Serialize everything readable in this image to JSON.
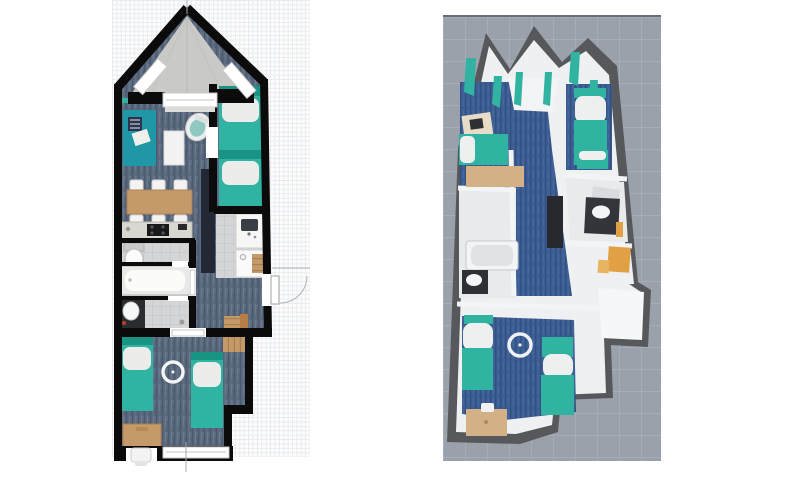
{
  "image": {
    "kind": "floor-plan comparison screenshot",
    "left_view": "2D top-down apartment floor plan on graph paper",
    "right_view": "3D aerial perspective render of the same apartment",
    "visible_text": ""
  },
  "colors": {
    "paper_bg": "#fdfdfe",
    "paper_line": "#e8ebed",
    "wall": "#0b0b0b",
    "carpet": "#5d6c81",
    "carpet_dark": "#4b5a6e",
    "carpet_light": "#6e7d91",
    "terrace": "#c9c9c5",
    "tile": "#d4d5d7",
    "tile_line": "#c0c2c4",
    "teal": "#2fb3a3",
    "teal_dark": "#189384",
    "rug": "#1f97a6",
    "wood": "#c59a6a",
    "wood_dark": "#a87f4e",
    "fixture": "#f4f5f4",
    "counter": "#dad7d0",
    "appliance": "#17181a",
    "wardrobe": "#232837",
    "doormat": "#b97c46",
    "ground": "#9aa1ab",
    "ground_line": "#a6adb6",
    "ground_edge": "#686d75",
    "wall3d": "#57585c",
    "innerwall": "#eef0f2",
    "carpet3d": "#3d5e95",
    "carpet3d_dark": "#31507f",
    "tile3d": "#e8eaec",
    "teal3d": "#31b3a2",
    "orange": "#e2a045",
    "wood3d": "#d3b086",
    "dark3d": "#27292f",
    "guide": "#a8adb2"
  },
  "plan2d": {
    "rooms": [
      "terrace",
      "living-room",
      "twin-bed-nook",
      "dining-area",
      "kitchen",
      "wc",
      "bathroom",
      "shower-room",
      "entrance-hall",
      "bedroom"
    ],
    "furniture": [
      "area-rug",
      "throw-pillows",
      "coffee-mat",
      "armchair",
      "wall-shelf",
      "single-bed-1",
      "single-bed-2",
      "tall-wardrobe",
      "dining-table",
      "dining-chairs-x6",
      "kitchen-counter",
      "cooktop",
      "toilet",
      "bathtub",
      "washbasin-vanity",
      "sink-counter",
      "shower-tray",
      "bath-mat",
      "entrance-door-with-swing",
      "doormat",
      "radiator-1",
      "radiator-2",
      "single-bed-3",
      "single-bed-4",
      "ceiling-lamp",
      "desk",
      "desk-chair"
    ]
  },
  "plan3d": {
    "rooms": [
      "gabled-terrace",
      "living-room",
      "bed-nook",
      "bathroom-left",
      "bathroom-right",
      "study-corner",
      "entrance-porch",
      "bedroom"
    ],
    "furniture": [
      "curtains",
      "desk-with-laptop",
      "daybed",
      "sideboard",
      "tall-wardrobe",
      "bathtub",
      "vanity-left",
      "vanity-right-with-mirror",
      "orange-towel",
      "orange-desk",
      "twin-bed-a",
      "twin-bed-b",
      "bed-left",
      "bed-right",
      "ceiling-lamp",
      "wood-desk"
    ]
  }
}
